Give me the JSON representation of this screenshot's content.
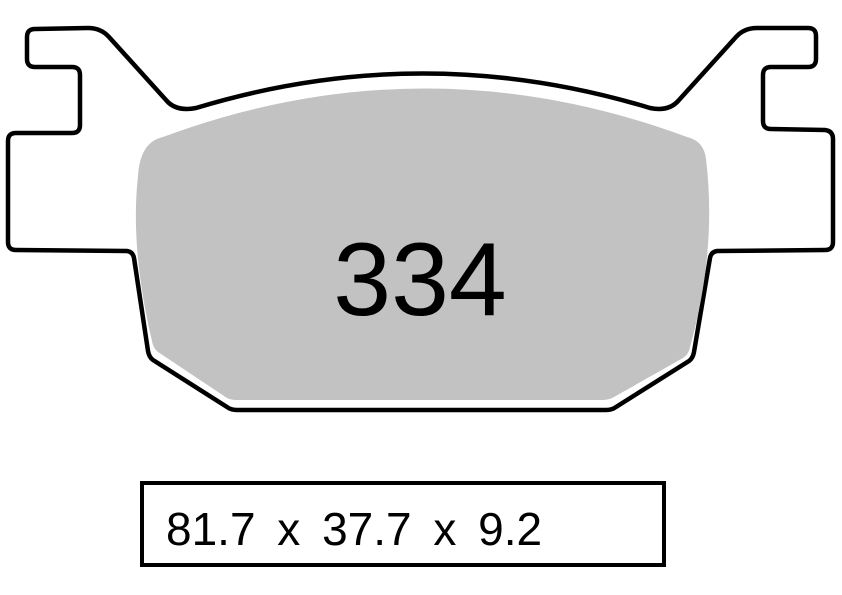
{
  "drawing": {
    "pad_number": "334",
    "dimensions": {
      "text": "81.7 x 37.7 x 9.2",
      "width_mm": "81.7",
      "height_mm": "37.7",
      "thickness_mm": "9.2"
    }
  },
  "colors": {
    "background": "#FFFFFF",
    "outline": "#000000",
    "friction_material": "#C2C2C2"
  }
}
